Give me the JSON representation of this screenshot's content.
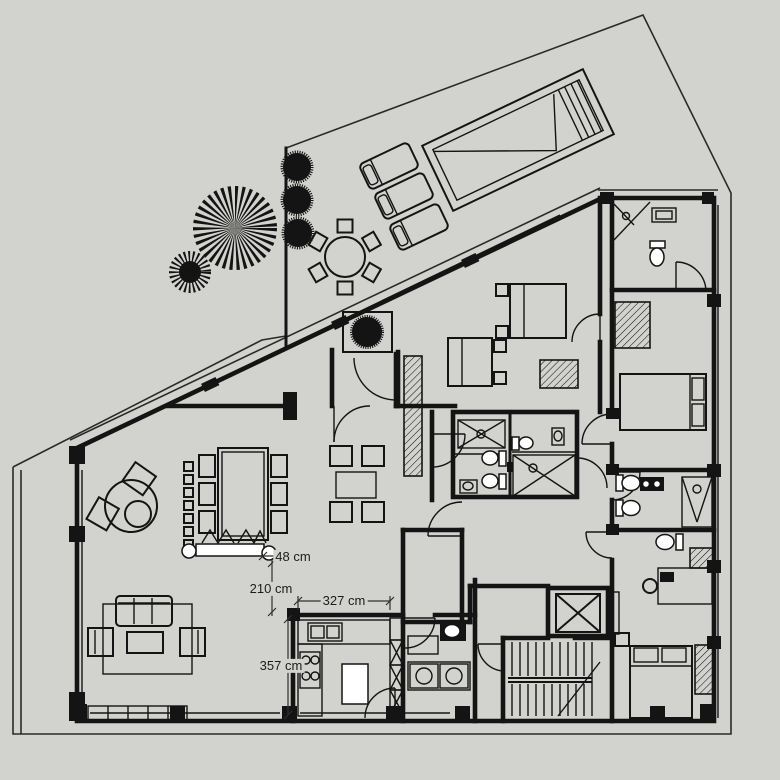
{
  "meta": {
    "title": "Apartment floor plan with pool terrace",
    "background_color": "#d2d2ce",
    "line_color": "#141414",
    "unit": "cm"
  },
  "dimensions": {
    "d48": {
      "label": "48 cm"
    },
    "d210": {
      "label": "210 cm"
    },
    "d327": {
      "label": "327 cm"
    },
    "d357": {
      "label": "357 cm"
    }
  },
  "icons": [
    "tree-spiky-icon",
    "tree-round-icon",
    "shrub-icon",
    "planter-tree-icon",
    "pool-icon",
    "sun-lounger-icon",
    "outdoor-table-icon",
    "dining-table-icon",
    "sofa-icon",
    "armchair-icon",
    "coffee-table-icon",
    "round-table-icon",
    "bed-icon",
    "wardrobe-icon",
    "toilet-icon",
    "sink-icon",
    "shower-icon",
    "stairs-icon",
    "elevator-icon",
    "kitchen-island-icon",
    "stove-icon",
    "washer-icon",
    "console-icon"
  ]
}
